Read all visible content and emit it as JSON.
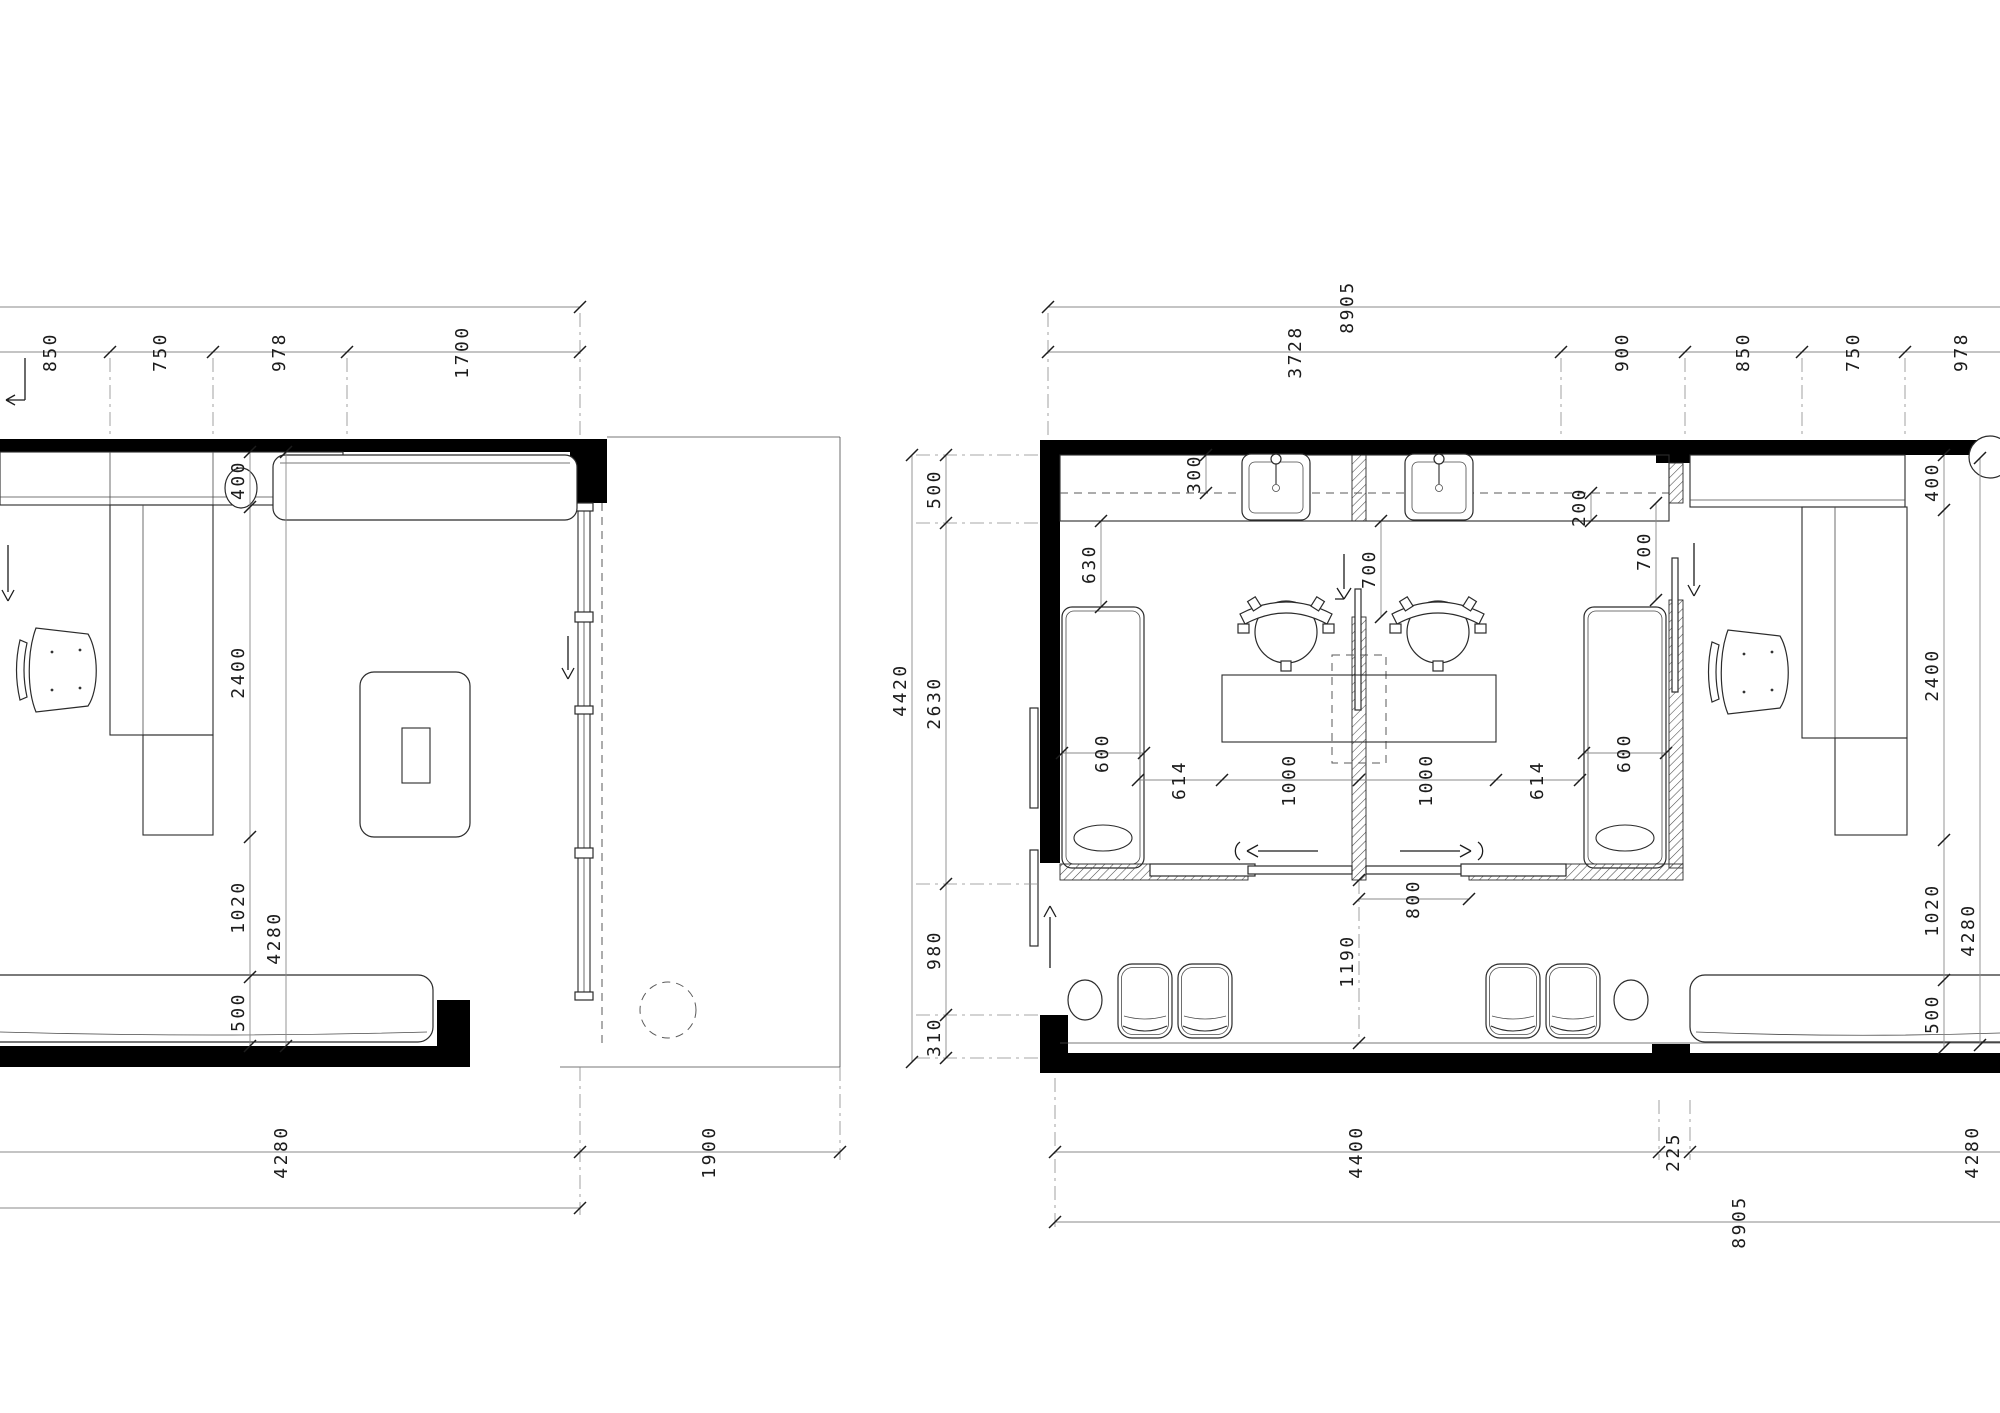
{
  "left_plan": {
    "top": [
      "850",
      "750",
      "978",
      "1700"
    ],
    "left": [
      "400",
      "2400",
      "1020",
      "500"
    ],
    "left_total": "4280",
    "bottom": [
      "4280",
      "1900"
    ]
  },
  "right_plan": {
    "top_total": "8905",
    "top": [
      "3728",
      "900",
      "850",
      "750",
      "978"
    ],
    "left": [
      "500",
      "2630",
      "980",
      "310"
    ],
    "left_total": "4420",
    "right": [
      "400",
      "2400",
      "1020",
      "500"
    ],
    "right_total": "4280",
    "bottom": [
      "4400",
      "225",
      "4280"
    ],
    "bottom_total": "8905",
    "interior": {
      "counter_back": "300",
      "counter_front": "200",
      "cab_gap": "630",
      "cab_left": "600",
      "cab_right": "600",
      "mid_opening": "700",
      "right_opening": "700",
      "table": [
        "614",
        "1000",
        "1000",
        "614"
      ],
      "door": "800",
      "waiting": "1190"
    }
  }
}
